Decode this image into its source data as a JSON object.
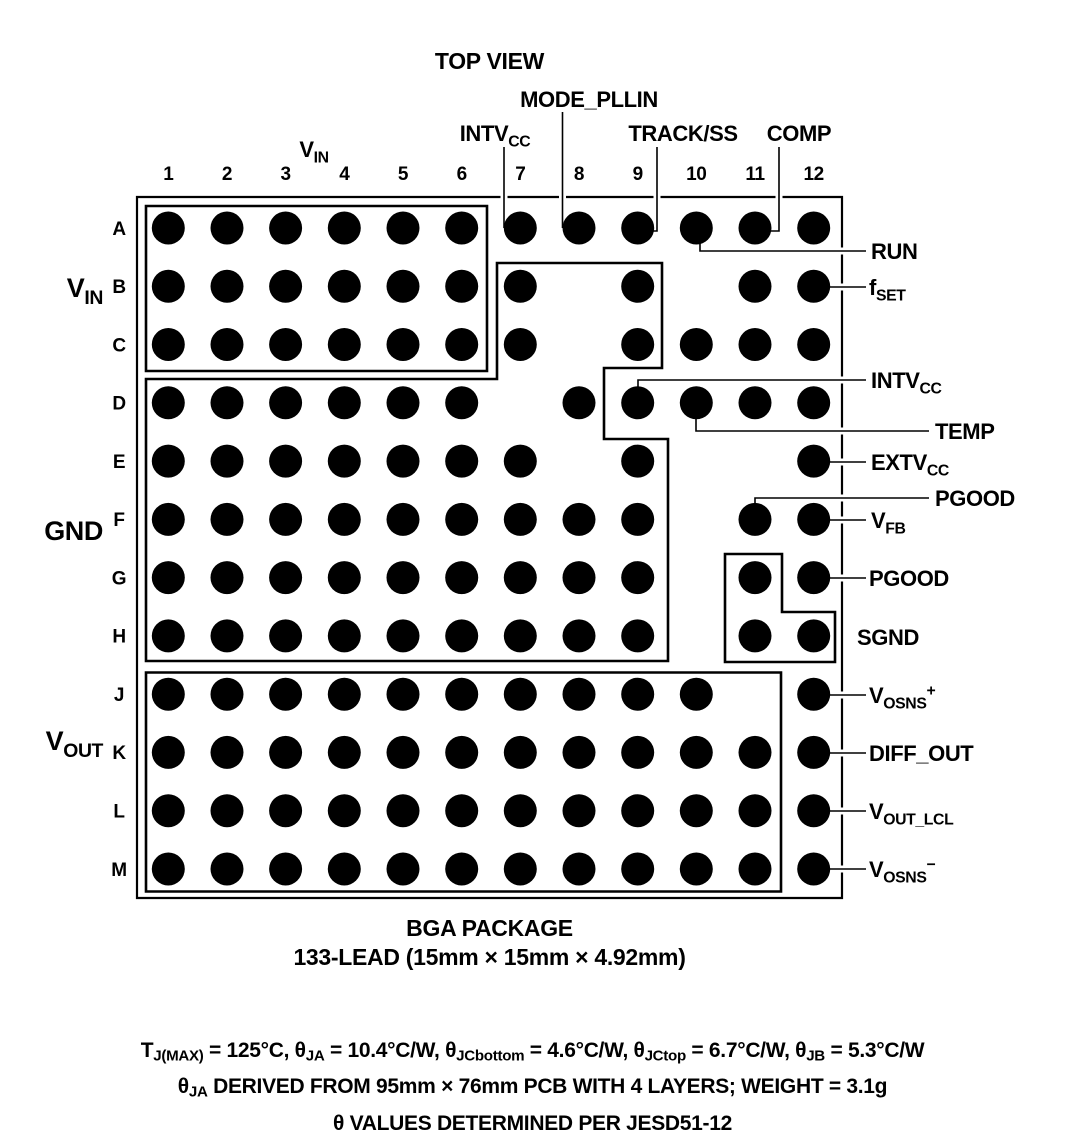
{
  "title": "TOP VIEW",
  "package": {
    "caption_line1": "BGA PACKAGE",
    "caption_line2": "133-LEAD (15mm × 15mm × 4.92mm)"
  },
  "notes": [
    "T_{J(MAX)} = 125°C, θ_{JA} = 10.4°C/W, θ_{JCbottom} = 4.6°C/W, θ_{JCtop} = 6.7°C/W, θ_{JB} = 5.3°C/W",
    "θ_{JA} DERIVED FROM 95mm × 76mm PCB WITH 4 LAYERS; WEIGHT = 3.1g",
    "θ VALUES DETERMINED PER JESD51-12"
  ],
  "grid": {
    "columns": [
      "1",
      "2",
      "3",
      "4",
      "5",
      "6",
      "7",
      "8",
      "9",
      "10",
      "11",
      "12"
    ],
    "rows": [
      "A",
      "B",
      "C",
      "D",
      "E",
      "F",
      "G",
      "H",
      "J",
      "K",
      "L",
      "M"
    ],
    "balls": {
      "A": [
        1,
        2,
        3,
        4,
        5,
        6,
        7,
        8,
        9,
        10,
        11,
        12
      ],
      "B": [
        1,
        2,
        3,
        4,
        5,
        6,
        7,
        9,
        11,
        12
      ],
      "C": [
        1,
        2,
        3,
        4,
        5,
        6,
        7,
        9,
        10,
        11,
        12
      ],
      "D": [
        1,
        2,
        3,
        4,
        5,
        6,
        8,
        9,
        10,
        11,
        12
      ],
      "E": [
        1,
        2,
        3,
        4,
        5,
        6,
        7,
        9,
        12
      ],
      "F": [
        1,
        2,
        3,
        4,
        5,
        6,
        7,
        8,
        9,
        11,
        12
      ],
      "G": [
        1,
        2,
        3,
        4,
        5,
        6,
        7,
        8,
        9,
        11,
        12
      ],
      "H": [
        1,
        2,
        3,
        4,
        5,
        6,
        7,
        8,
        9,
        11,
        12
      ],
      "J": [
        1,
        2,
        3,
        4,
        5,
        6,
        7,
        8,
        9,
        10,
        12
      ],
      "K": [
        1,
        2,
        3,
        4,
        5,
        6,
        7,
        8,
        9,
        10,
        11,
        12
      ],
      "L": [
        1,
        2,
        3,
        4,
        5,
        6,
        7,
        8,
        9,
        10,
        11,
        12
      ],
      "M": [
        1,
        2,
        3,
        4,
        5,
        6,
        7,
        8,
        9,
        10,
        11,
        12
      ]
    }
  },
  "group_labels": {
    "column_header": {
      "id": "vin-col",
      "text": "V_{IN}"
    },
    "left": [
      {
        "id": "vin",
        "text": "V_{IN}"
      },
      {
        "id": "gnd",
        "text": "GND"
      },
      {
        "id": "vout",
        "text": "V_{OUT}"
      }
    ]
  },
  "pin_labels": {
    "top": [
      {
        "id": "intvcc-top",
        "text": "INTV_{CC}",
        "pin": "A7"
      },
      {
        "id": "mode-pllin",
        "text": "MODE_PLLIN",
        "pin": "A8"
      },
      {
        "id": "track-ss",
        "text": "TRACK/SS",
        "pin": "A9"
      },
      {
        "id": "comp",
        "text": "COMP",
        "pin": "A11"
      }
    ],
    "right": [
      {
        "id": "run",
        "text": "RUN",
        "pin": "A10"
      },
      {
        "id": "fset",
        "text": "f_{SET}",
        "pin": "B12"
      },
      {
        "id": "intvcc-right",
        "text": "INTV_{CC}",
        "pin": "D9"
      },
      {
        "id": "temp",
        "text": "TEMP",
        "pin": "D10"
      },
      {
        "id": "extvcc",
        "text": "EXTV_{CC}",
        "pin": "E12"
      },
      {
        "id": "pgood-upper",
        "text": "PGOOD",
        "pin": "F11"
      },
      {
        "id": "vfb",
        "text": "V_{FB}",
        "pin": "F12"
      },
      {
        "id": "pgood-lower",
        "text": "PGOOD",
        "pin": "G12"
      },
      {
        "id": "sgnd",
        "text": "SGND",
        "pin": ""
      },
      {
        "id": "vosns-plus",
        "text": "V_{OSNS}^{+}",
        "pin": "J12"
      },
      {
        "id": "diff-out",
        "text": "DIFF_OUT",
        "pin": "K12"
      },
      {
        "id": "vout-lcl",
        "text": "V_{OUT_LCL}",
        "pin": "L12"
      },
      {
        "id": "vosns-minus",
        "text": "V_{OSNS}^{−}",
        "pin": "M12"
      }
    ]
  },
  "colors": {
    "ink": "#000000",
    "paper": "#ffffff"
  }
}
